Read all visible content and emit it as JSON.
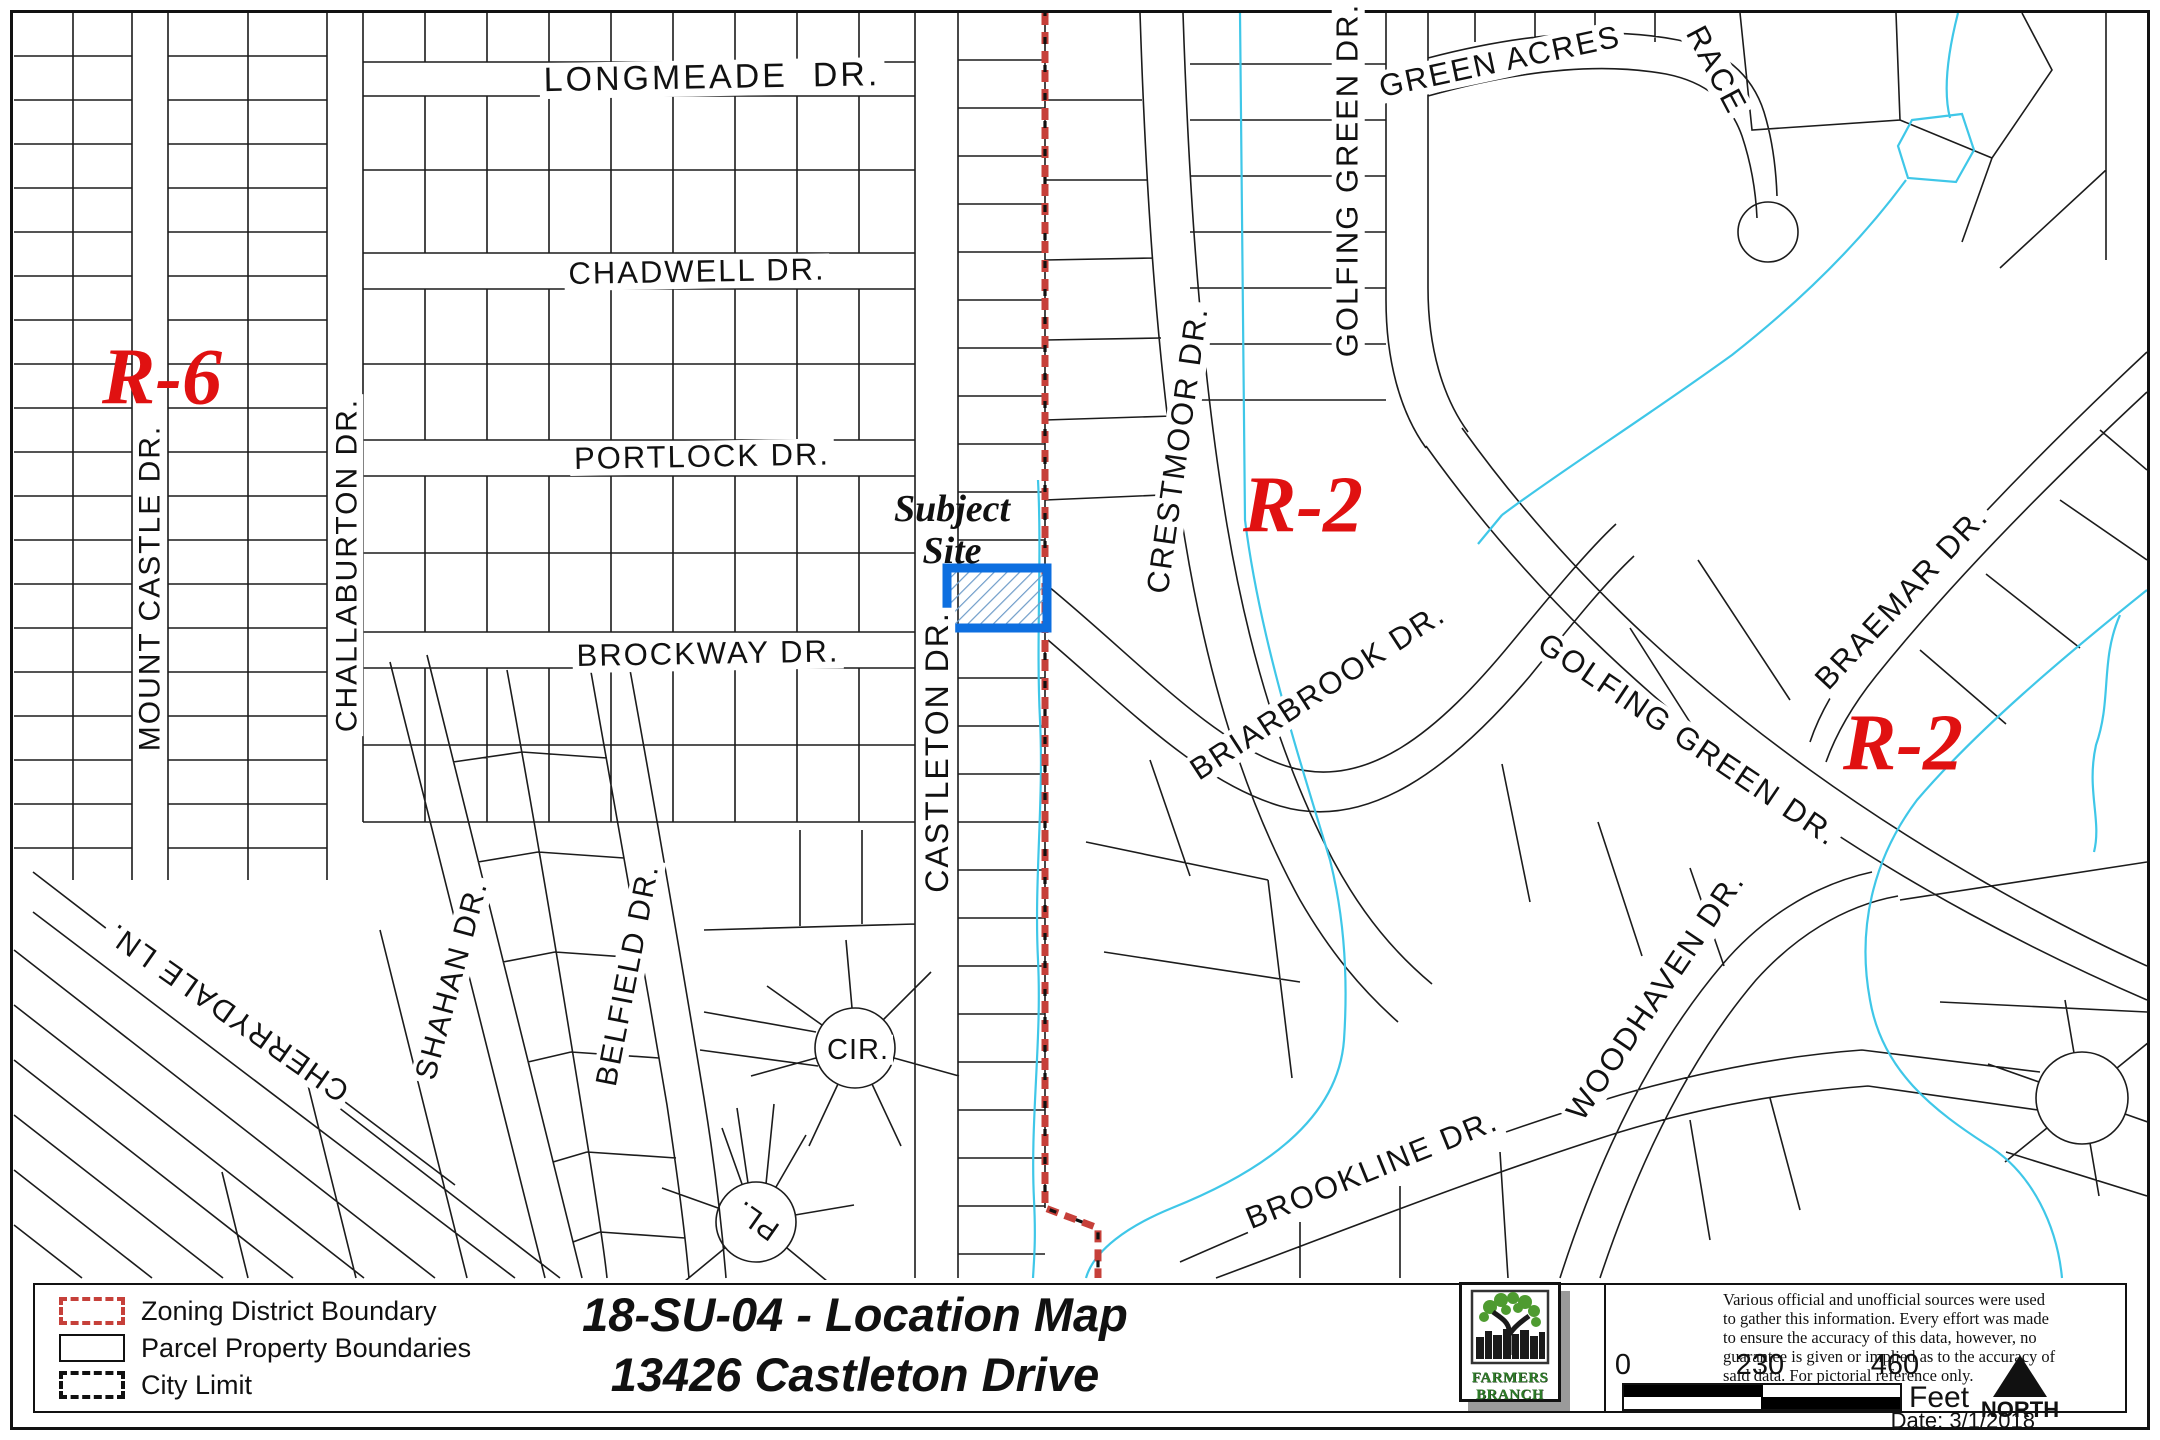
{
  "page": {
    "title_line1": "18-SU-04 - Location Map",
    "title_line2": "13426 Castleton Drive",
    "date_label": "Date: 3/1/2018"
  },
  "legend": {
    "items": [
      {
        "label": "Zoning District Boundary",
        "symbol": "zoning-district-boundary"
      },
      {
        "label": "Parcel Property Boundaries",
        "symbol": "parcel-property-boundaries"
      },
      {
        "label": "City Limit",
        "symbol": "city-limit"
      }
    ]
  },
  "logo": {
    "name_line1": "FARMERS",
    "name_line2": "BRANCH"
  },
  "disclaimer": "Various official and unofficial sources were used to gather this information. Every effort was made to ensure the accuracy of this data, however, no guarantee is given or implied as to the accuracy of said data.  For pictorial reference only.",
  "scale_bar": {
    "ticks": [
      "0",
      "230",
      "460"
    ],
    "unit": "Feet"
  },
  "north_label": "NORTH",
  "map": {
    "subject_site": {
      "line1": "Subject",
      "line2": "Site"
    },
    "zoning_labels": [
      {
        "name": "r6",
        "text": "R-6",
        "x": 162,
        "y": 378,
        "rot": 0,
        "size": 80
      },
      {
        "name": "r2-central",
        "text": "R-2",
        "x": 1303,
        "y": 506,
        "rot": 0,
        "size": 80
      },
      {
        "name": "r2-east",
        "text": "R-2",
        "x": 1903,
        "y": 744,
        "rot": 0,
        "size": 80
      }
    ],
    "street_labels": [
      {
        "name": "longmeade-dr",
        "text": "LONGMEADE  DR.",
        "x": 712,
        "y": 78,
        "rot": -1,
        "size": 34,
        "ls": 3
      },
      {
        "name": "chadwell-dr",
        "text": "CHADWELL DR.",
        "x": 697,
        "y": 272,
        "rot": -1,
        "size": 31,
        "ls": 2
      },
      {
        "name": "portlock-dr",
        "text": "PORTLOCK DR.",
        "x": 702,
        "y": 457,
        "rot": -1,
        "size": 31,
        "ls": 2
      },
      {
        "name": "brockway-dr",
        "text": "BROCKWAY DR.",
        "x": 708,
        "y": 654,
        "rot": -1,
        "size": 31,
        "ls": 2
      },
      {
        "name": "mount-castle-dr",
        "text": "MOUNT CASTLE DR.",
        "x": 150,
        "y": 588,
        "rot": -90,
        "size": 30,
        "ls": 2
      },
      {
        "name": "challaburton-dr",
        "text": "CHALLABURTON DR.",
        "x": 347,
        "y": 565,
        "rot": -90,
        "size": 30,
        "ls": 2
      },
      {
        "name": "shahan-dr",
        "text": "SHAHAN DR.",
        "x": 452,
        "y": 980,
        "rot": -75,
        "size": 30,
        "ls": 2
      },
      {
        "name": "belfield-dr",
        "text": "BELFIELD DR.",
        "x": 628,
        "y": 975,
        "rot": -79,
        "size": 30,
        "ls": 2
      },
      {
        "name": "cherrydale-ln",
        "text": "CHERRYDALE LN.",
        "x": 228,
        "y": 1012,
        "rot": 215,
        "size": 30,
        "ls": 2
      },
      {
        "name": "castleton-dr",
        "text": "CASTLETON DR.",
        "x": 938,
        "y": 752,
        "rot": -90,
        "size": 32,
        "ls": 2
      },
      {
        "name": "crestmoor-dr",
        "text": "CRESTMOOR DR.",
        "x": 1178,
        "y": 450,
        "rot": -82,
        "size": 31,
        "ls": 2
      },
      {
        "name": "golfing-green-dr-n",
        "text": "GOLFING GREEN DR.",
        "x": 1348,
        "y": 180,
        "rot": -90,
        "size": 31,
        "ls": 2
      },
      {
        "name": "green-acres",
        "text": "GREEN ACRES",
        "x": 1500,
        "y": 62,
        "rot": -12,
        "size": 31,
        "ls": 2
      },
      {
        "name": "green-acres-race",
        "text": "RACE",
        "x": 1716,
        "y": 70,
        "rot": 62,
        "size": 31,
        "ls": 2
      },
      {
        "name": "briarbrook-dr",
        "text": "BRIARBROOK DR.",
        "x": 1318,
        "y": 692,
        "rot": -33,
        "size": 31,
        "ls": 2
      },
      {
        "name": "golfing-green-dr-s",
        "text": "GOLFING GREEN DR.",
        "x": 1688,
        "y": 740,
        "rot": 34,
        "size": 31,
        "ls": 2
      },
      {
        "name": "braemar-dr",
        "text": "BRAEMAR DR.",
        "x": 1902,
        "y": 598,
        "rot": -47,
        "size": 31,
        "ls": 2
      },
      {
        "name": "woodhaven-dr",
        "text": "WOODHAVEN DR.",
        "x": 1656,
        "y": 996,
        "rot": -56,
        "size": 31,
        "ls": 2
      },
      {
        "name": "brookline-dr",
        "text": "BROOKLINE DR.",
        "x": 1372,
        "y": 1170,
        "rot": -22,
        "size": 31,
        "ls": 2
      },
      {
        "name": "cir",
        "text": "CIR.",
        "x": 858,
        "y": 1050,
        "rot": 0,
        "size": 29,
        "ls": 1
      },
      {
        "name": "pl",
        "text": "PL.",
        "x": 757,
        "y": 1220,
        "rot": 215,
        "size": 29,
        "ls": 1
      }
    ]
  },
  "colors": {
    "zoning_label_red": "#e01111",
    "boundary_red": "#c6403a",
    "subject_blue": "#0d6fe0",
    "creek_cyan": "#3fc7e8",
    "logo_green": "#2e7d28"
  }
}
